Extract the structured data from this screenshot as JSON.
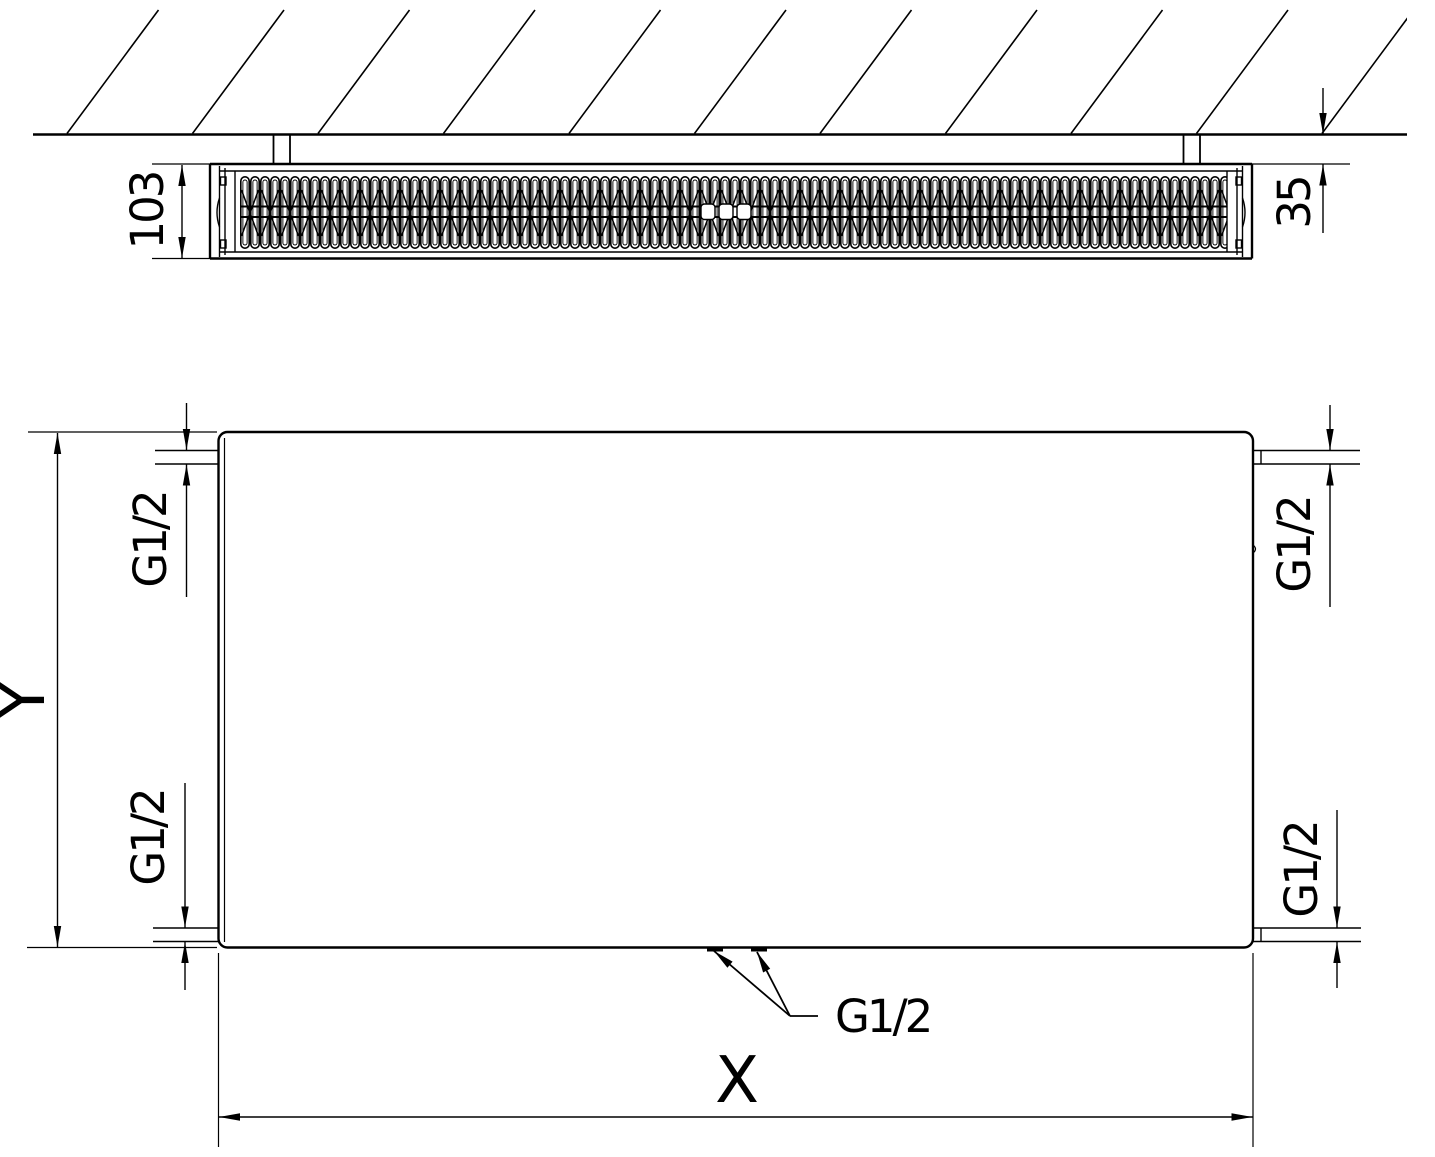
{
  "drawing": {
    "section_view": {
      "depth_dimension": "103",
      "wall_clearance_dimension": "35"
    },
    "front_view": {
      "width_dimension": "X",
      "height_dimension": "Y",
      "thread_top_left": "G1/2",
      "thread_top_right": "G1/2",
      "thread_bottom_left": "G1/2",
      "thread_bottom_right": "G1/2",
      "thread_bottom_center": "G1/2"
    },
    "line_color": "#000000",
    "background_color": "#ffffff"
  }
}
